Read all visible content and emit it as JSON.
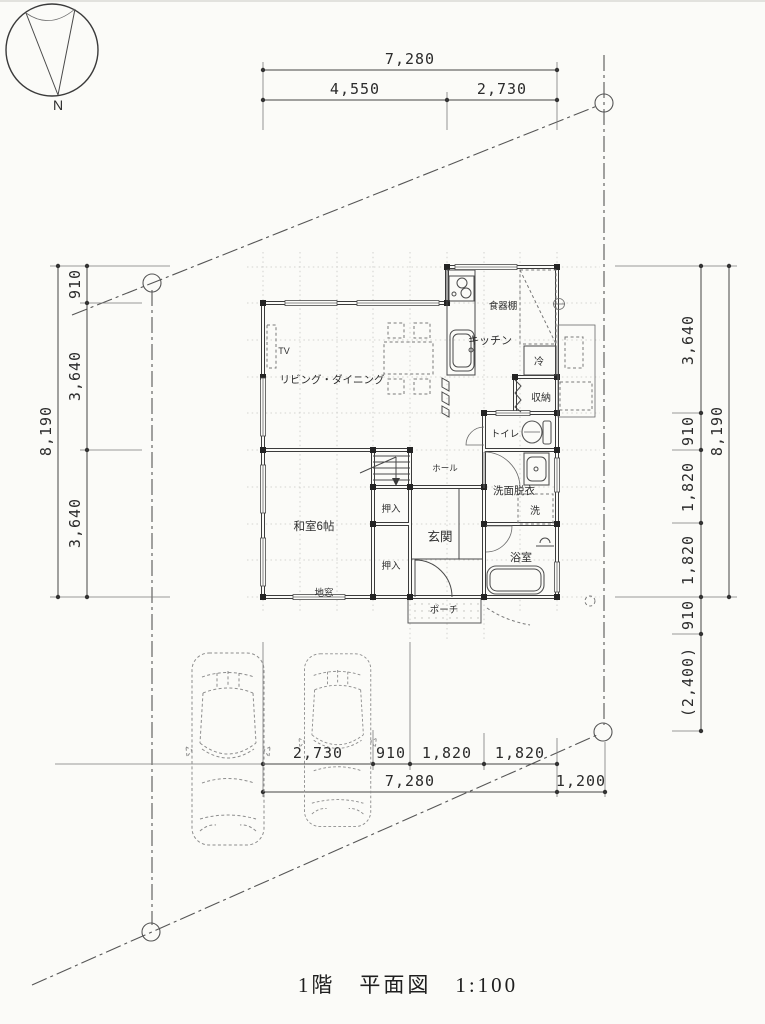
{
  "title": "1階　平面図　1:100",
  "compass": {
    "north": "N"
  },
  "dims": {
    "top": {
      "total": "7,280",
      "a": "4,550",
      "b": "2,730"
    },
    "left": {
      "total": "8,190",
      "a": "910",
      "b": "3,640",
      "c": "3,640"
    },
    "right": {
      "total": "8,190",
      "a": "3,640",
      "b": "910",
      "c": "1,820",
      "d": "1,820",
      "e": "910",
      "f": "(2,400)"
    },
    "bottom": {
      "a": "2,730",
      "b": "910",
      "c": "1,820",
      "d": "1,820",
      "total": "7,280",
      "extra": "1,200"
    }
  },
  "rooms": {
    "kitchen": "キッチン",
    "living": "リビング・ダイニング",
    "washitsu": "和室6帖",
    "genkan": "玄関",
    "hall": "ホール",
    "toilet": "トイレ",
    "washroom": "洗面脱衣",
    "bath": "浴室",
    "storage": "収納",
    "closet1": "押入",
    "closet2": "押入",
    "porch": "ポーチ",
    "jimado": "地窓"
  },
  "fixtures": {
    "tv": "TV",
    "fridge": "冷",
    "washer": "洗",
    "cupboard": "食器棚"
  }
}
